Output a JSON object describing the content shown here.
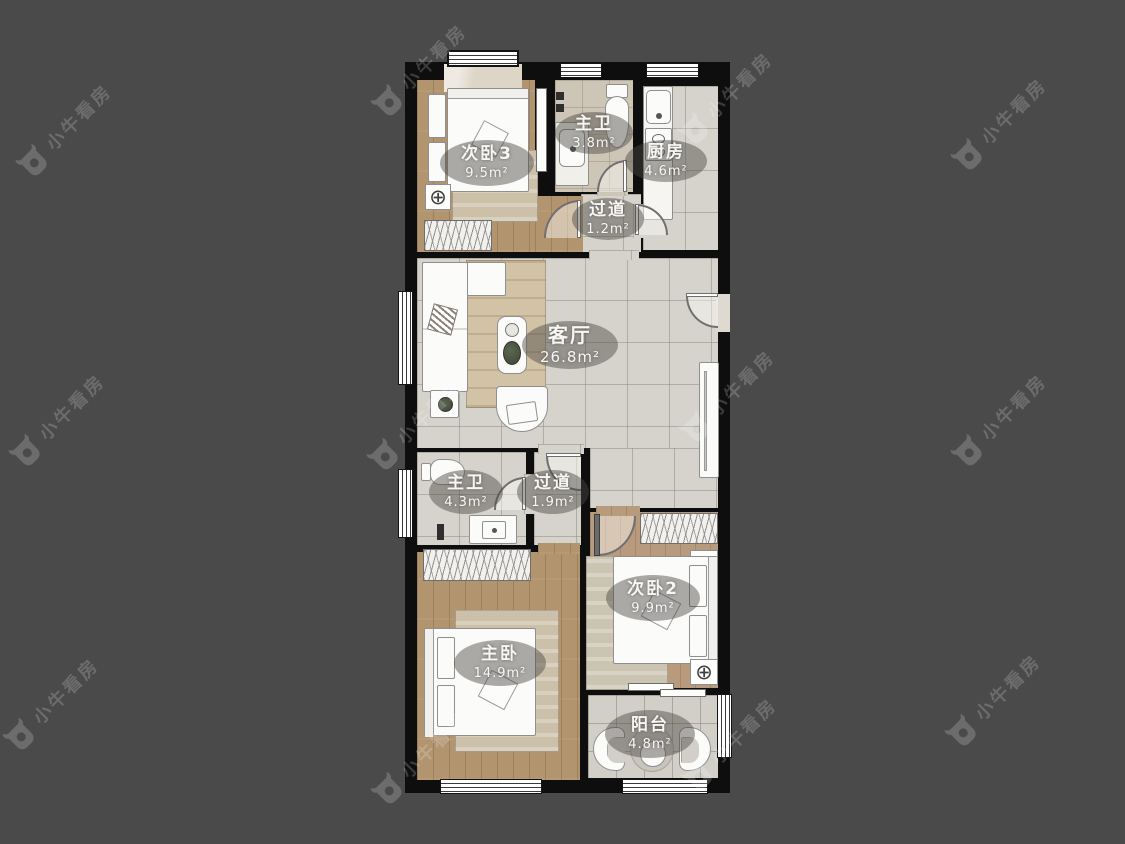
{
  "watermark": {
    "text": "小牛看房"
  },
  "icons": {
    "ac_unit": "⊕"
  },
  "plan": {
    "rooms": [
      {
        "name": "次卧3",
        "area": "9.5m²"
      },
      {
        "name": "主卫",
        "area": "3.8m²"
      },
      {
        "name": "厨房",
        "area": "4.6m²"
      },
      {
        "name": "过道",
        "area": "1.2m²"
      },
      {
        "name": "客厅",
        "area": "26.8m²"
      },
      {
        "name": "主卫",
        "area": "4.3m²"
      },
      {
        "name": "过道",
        "area": "1.9m²"
      },
      {
        "name": "次卧2",
        "area": "9.9m²"
      },
      {
        "name": "主卧",
        "area": "14.9m²"
      },
      {
        "name": "阳台",
        "area": "4.8m²"
      }
    ]
  }
}
